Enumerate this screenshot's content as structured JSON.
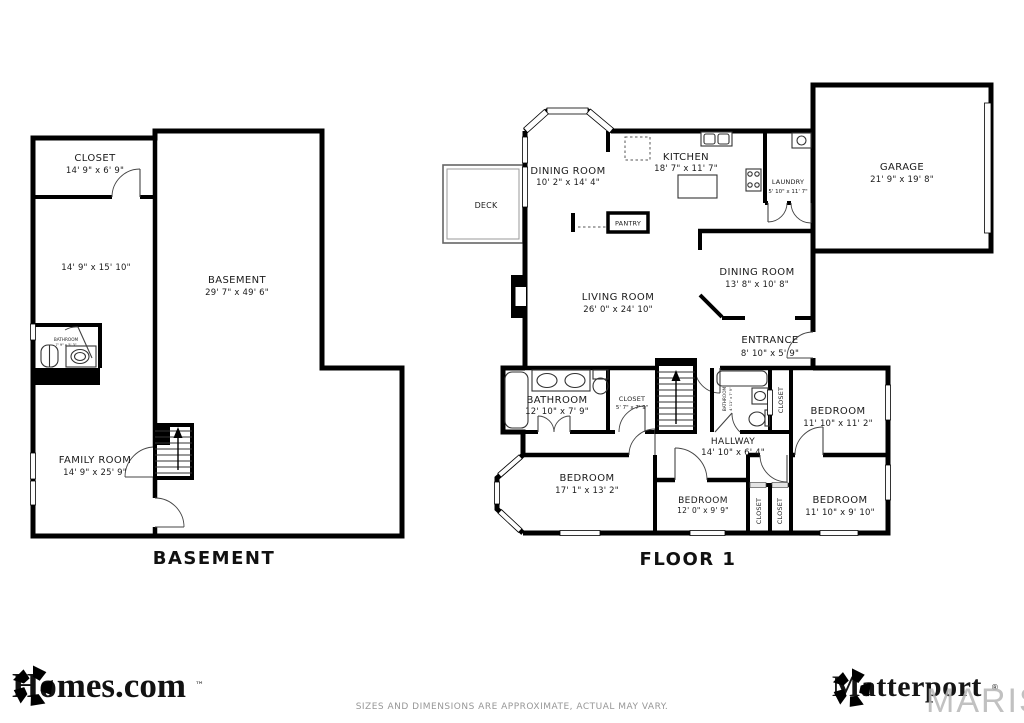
{
  "basement": {
    "title": "BASEMENT",
    "closet": {
      "name": "CLOSET",
      "dims": "14' 9\" x 6' 9\""
    },
    "room": {
      "dims": "14' 9\" x 15' 10\""
    },
    "main": {
      "name": "BASEMENT",
      "dims": "29' 7\" x 49' 6\""
    },
    "bathroom": {
      "name": "BATHROOM",
      "dims": "7' 9\" x 5' 3\""
    },
    "family_room": {
      "name": "FAMILY ROOM",
      "dims": "14' 9\" x 25' 9\""
    }
  },
  "floor1": {
    "title": "FLOOR 1",
    "deck": {
      "name": "DECK"
    },
    "dining_room_1": {
      "name": "DINING ROOM",
      "dims": "10' 2\" x 14' 4\""
    },
    "kitchen": {
      "name": "KITCHEN",
      "dims": "18' 7\" x 11' 7\""
    },
    "pantry": {
      "name": "PANTRY"
    },
    "laundry": {
      "name": "LAUNDRY",
      "dims": "5' 10\" x 11' 7\""
    },
    "garage": {
      "name": "GARAGE",
      "dims": "21' 9\" x 19' 8\""
    },
    "living_room": {
      "name": "LIVING ROOM",
      "dims": "26' 0\" x 24' 10\""
    },
    "dining_room_2": {
      "name": "DINING ROOM",
      "dims": "13' 8\" x 10' 8\""
    },
    "entrance": {
      "name": "ENTRANCE",
      "dims": "8' 10\" x 5' 9\""
    },
    "bathroom_main": {
      "name": "BATHROOM",
      "dims": "12' 10\" x 7' 9\""
    },
    "closet_hall": {
      "name": "CLOSET",
      "dims": "5' 7\" x 7' 9\""
    },
    "hallway": {
      "name": "HALLWAY",
      "dims": "14' 10\" x 6' 4\""
    },
    "bathroom_small": {
      "name": "BATHROOM",
      "dims": "4' 11\" x 7' 9\""
    },
    "closet_ne": {
      "name": "CLOSET"
    },
    "bedroom_ne": {
      "name": "BEDROOM",
      "dims": "11' 10\" x 11' 2\""
    },
    "bedroom_sw": {
      "name": "BEDROOM",
      "dims": "17' 1\" x 13' 2\""
    },
    "bedroom_s": {
      "name": "BEDROOM",
      "dims": "12' 0\" x 9' 9\""
    },
    "closet_s1": {
      "name": "CLOSET"
    },
    "closet_s2": {
      "name": "CLOSET"
    },
    "bedroom_se": {
      "name": "BEDROOM",
      "dims": "11' 10\" x 9' 10\""
    }
  },
  "footer": {
    "homes_brand": "Homes.com",
    "homes_tm": "™",
    "matterport_brand": "Matterport",
    "matterport_reg": "®",
    "watermark": "MARIS",
    "disclaimer": "SIZES AND DIMENSIONS ARE APPROXIMATE, ACTUAL MAY VARY."
  },
  "colors": {
    "wall": "#000000",
    "window_fill": "#fdfdfd",
    "label": "#1b1b1b",
    "muted_text": "#979797",
    "watermark_gray": "#b7b7b7"
  }
}
